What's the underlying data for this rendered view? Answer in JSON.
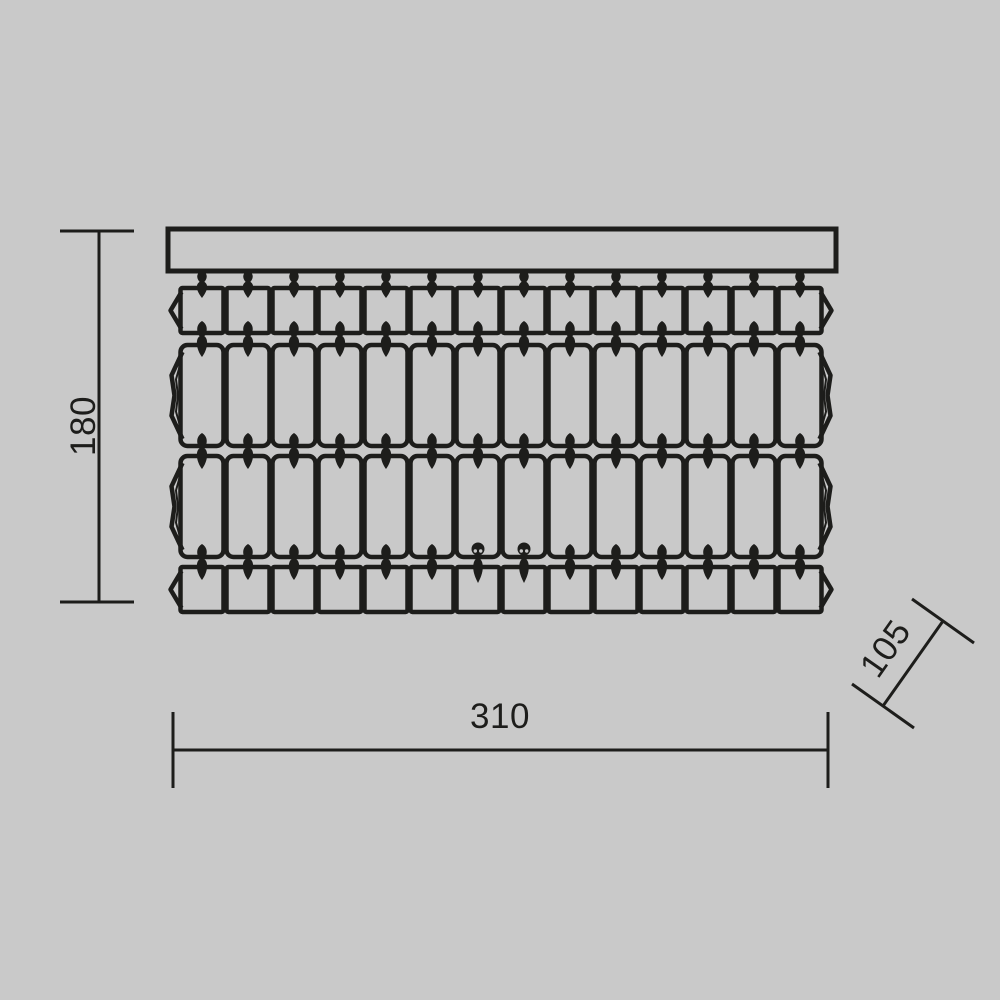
{
  "figure": {
    "name": "Chandelier dimensional drawing",
    "view": "front elevation",
    "colors": {
      "background": "#c9c9c9",
      "ink": "#1d1d1b"
    },
    "canopy": {
      "shape": "rectangular mounting bar"
    },
    "crystal_grid": {
      "columns": 14,
      "rows": [
        {
          "name": "top short crystal row",
          "crystals": 14
        },
        {
          "name": "upper tall crystal row",
          "crystals": 14
        },
        {
          "name": "lower tall crystal row",
          "crystals": 14
        },
        {
          "name": "bottom short crystal row",
          "crystals": 14
        }
      ],
      "bead_connector_rows": 4,
      "ball_pin_columns": [
        7,
        8
      ]
    }
  },
  "dimensions": {
    "height": {
      "label": "180"
    },
    "width": {
      "label": "310"
    },
    "depth": {
      "label": "105"
    }
  }
}
